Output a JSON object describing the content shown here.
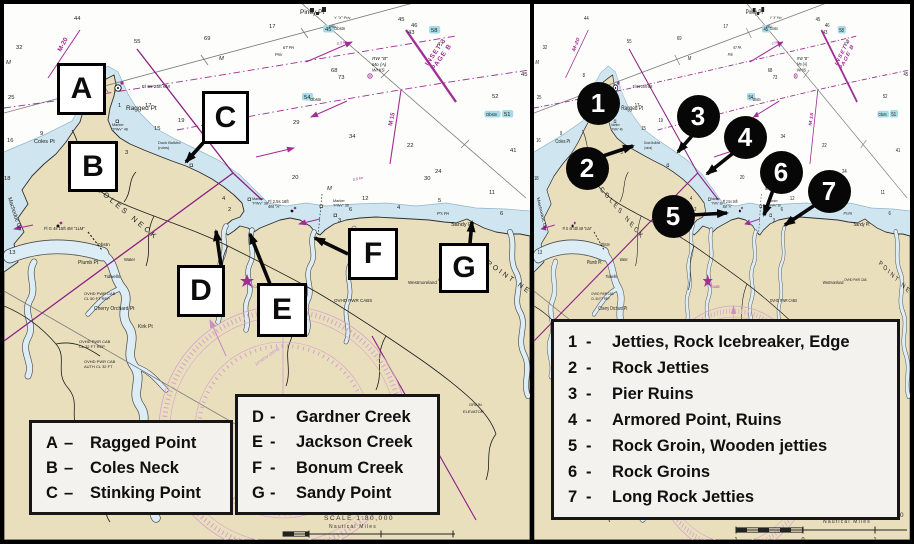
{
  "colors": {
    "land": "#e9dfbd",
    "shallow_water": "#cfe5ef",
    "creek": "#dcedf5",
    "magenta": "#a12d96",
    "pale_rose": "#d5a3cc",
    "teal_highlight": "#a8dbe8",
    "marker_black": "#070707"
  },
  "map": {
    "labels": [
      {
        "t": "Piney Pt",
        "x": 296,
        "y": 10,
        "s": 6.5
      },
      {
        "t": "Ragged Pt",
        "x": 122,
        "y": 106,
        "s": 6.5
      },
      {
        "t": "Coles Pt",
        "x": 30,
        "y": 139,
        "s": 5.5
      },
      {
        "t": "COLES NECK",
        "x": 92,
        "y": 186,
        "s": 7.5,
        "r": 40,
        "ls": 3
      },
      {
        "t": "Machodoc Cr",
        "x": 4,
        "y": 194,
        "s": 5.5,
        "r": 72
      },
      {
        "t": "Plumb Pt",
        "x": 74,
        "y": 260,
        "s": 5
      },
      {
        "t": "Tidwells",
        "x": 100,
        "y": 274,
        "s": 4.5
      },
      {
        "t": "Cherry Orchard Pt",
        "x": 90,
        "y": 306,
        "s": 5
      },
      {
        "t": "Kirk Pt",
        "x": 134,
        "y": 324,
        "s": 5
      },
      {
        "t": "Sandy Pt",
        "x": 447,
        "y": 222,
        "s": 5.5
      },
      {
        "t": "POINT NECK",
        "x": 482,
        "y": 260,
        "s": 7,
        "r": 35,
        "ls": 2.5
      },
      {
        "t": "Westmoreland",
        "x": 404,
        "y": 280,
        "s": 4.5
      },
      {
        "t": "Obstn",
        "x": 93,
        "y": 242,
        "s": 4.8
      },
      {
        "t": "Water",
        "x": 120,
        "y": 257,
        "s": 4.2
      },
      {
        "t": "Fl 6s 25ft 6M",
        "x": 138,
        "y": 84,
        "s": 4.8
      },
      {
        "t": "Fl G 4s 15ft 4M \"1LM\"",
        "x": 40,
        "y": 226,
        "s": 4.2
      },
      {
        "lines": [
          "Fl 2.5s 16ft",
          "4M \"A\""
        ],
        "x": 264,
        "y": 199,
        "s": 4.2
      },
      {
        "lines": [
          "RW \"B\"",
          "Mo (A)",
          "WHIS"
        ],
        "x": 368,
        "y": 56,
        "s": 4.8,
        "i": 1
      },
      {
        "t": "Priv",
        "x": 271,
        "y": 52,
        "s": 4.2,
        "i": 1
      },
      {
        "t": "Priv",
        "x": 325,
        "y": 24,
        "s": 4.2,
        "i": 1
      },
      {
        "t": "67 PA",
        "x": 279,
        "y": 45,
        "s": 4.2,
        "i": 1
      },
      {
        "t": "Y \"X\" Priv",
        "x": 330,
        "y": 15,
        "s": 3.8,
        "i": 1
      },
      {
        "lines": [
          "Dock Bulkhd",
          "(ruins)"
        ],
        "x": 154,
        "y": 140,
        "s": 4
      },
      {
        "lines": [
          "Marker",
          "\"PWv\" 46"
        ],
        "x": 108,
        "y": 122,
        "s": 3.8
      },
      {
        "lines": [
          "Marker",
          "\"PWv\" 38"
        ],
        "x": 248,
        "y": 196,
        "s": 3.8
      },
      {
        "lines": [
          "Marker",
          "\"PWv\" 38"
        ],
        "x": 329,
        "y": 198,
        "s": 3.8
      },
      {
        "t": "OVHD PWR CABS",
        "x": 330,
        "y": 298,
        "s": 4.5
      },
      {
        "lines": [
          "OVHD PWR CAB",
          "CL 50 FT REP"
        ],
        "x": 80,
        "y": 291,
        "s": 4
      },
      {
        "lines": [
          "OVHD PWR CAB",
          "CL 32 FT REP"
        ],
        "x": 75,
        "y": 339,
        "s": 4
      },
      {
        "lines": [
          "OVHD PWR CAB",
          "AUTH CL 32 FT"
        ],
        "x": 80,
        "y": 359,
        "s": 4
      },
      {
        "t": "OVHD PWR CAB",
        "x": 434,
        "y": 277,
        "s": 4
      },
      {
        "t": "M-20",
        "x": 57,
        "y": 48,
        "s": 6.5,
        "r": -62,
        "c": "#a12d96",
        "b": 1
      },
      {
        "t": "M 15",
        "x": 388,
        "y": 122,
        "s": 6,
        "r": -78,
        "c": "#a12d96",
        "b": 1
      },
      {
        "lines": [
          "INSET 3",
          "PAGE B"
        ],
        "x": 424,
        "y": 62,
        "s": 6.5,
        "r": -55,
        "c": "#a12d96",
        "b": 1,
        "ls": 1
      },
      {
        "t": "0.3 kn",
        "x": 333,
        "y": 41,
        "s": 3.8,
        "r": -12,
        "c": "#a12d96",
        "i": 1
      },
      {
        "t": "0.5 kn",
        "x": 349,
        "y": 177,
        "s": 3.8,
        "r": -12,
        "c": "#a12d96",
        "i": 1
      },
      {
        "t": "10°48'W (2016)",
        "x": 252,
        "y": 362,
        "s": 4.2,
        "r": -35,
        "c": "#c98fc2",
        "i": 1
      },
      {
        "t": "T CABS",
        "x": 246,
        "y": 284,
        "s": 3.8,
        "c": "#a12d96"
      },
      {
        "t": "Obstn",
        "x": 306,
        "y": 97,
        "s": 4.2
      },
      {
        "t": "Obstn",
        "x": 330,
        "y": 26,
        "s": 4.2
      },
      {
        "t": "Obstn",
        "x": 482,
        "y": 112,
        "s": 4.2,
        "hl": 1
      },
      {
        "t": "GRAIN",
        "x": 465,
        "y": 402,
        "s": 4
      },
      {
        "t": "ELEVATOR",
        "x": 459,
        "y": 409,
        "s": 4
      },
      {
        "t": "P's PA",
        "x": 433,
        "y": 211,
        "s": 4.2,
        "i": 1
      }
    ],
    "depths": [
      {
        "v": "44",
        "x": 70,
        "y": 16
      },
      {
        "v": "55",
        "x": 130,
        "y": 39
      },
      {
        "v": "69",
        "x": 200,
        "y": 36
      },
      {
        "v": "17",
        "x": 265,
        "y": 24
      },
      {
        "v": "M",
        "x": 215,
        "y": 56,
        "i": 1
      },
      {
        "v": "32",
        "x": 12,
        "y": 45
      },
      {
        "v": "M",
        "x": 2,
        "y": 60,
        "i": 1
      },
      {
        "v": "25",
        "x": 4,
        "y": 95
      },
      {
        "v": "16",
        "x": 3,
        "y": 138
      },
      {
        "v": "18",
        "x": 0,
        "y": 176
      },
      {
        "v": "13",
        "x": 5,
        "y": 250
      },
      {
        "v": "9",
        "x": 36,
        "y": 131
      },
      {
        "v": "8",
        "x": 68,
        "y": 73
      },
      {
        "v": "3",
        "x": 121,
        "y": 150
      },
      {
        "v": "17",
        "x": 141,
        "y": 103
      },
      {
        "v": "15",
        "x": 150,
        "y": 126
      },
      {
        "v": "19",
        "x": 174,
        "y": 118
      },
      {
        "v": "1",
        "x": 114,
        "y": 103
      },
      {
        "v": "3",
        "x": 88,
        "y": 162
      },
      {
        "v": "4",
        "x": 218,
        "y": 196
      },
      {
        "v": "2",
        "x": 224,
        "y": 207
      },
      {
        "v": "20",
        "x": 288,
        "y": 175
      },
      {
        "v": "M",
        "x": 323,
        "y": 186,
        "i": 1
      },
      {
        "v": "12",
        "x": 358,
        "y": 196
      },
      {
        "v": "6",
        "x": 345,
        "y": 207
      },
      {
        "v": "3",
        "x": 334,
        "y": 218
      },
      {
        "v": "4",
        "x": 393,
        "y": 205
      },
      {
        "v": "30",
        "x": 420,
        "y": 176
      },
      {
        "v": "29",
        "x": 289,
        "y": 120
      },
      {
        "v": "34",
        "x": 345,
        "y": 134
      },
      {
        "v": "22",
        "x": 403,
        "y": 143
      },
      {
        "v": "24",
        "x": 431,
        "y": 169
      },
      {
        "v": "11",
        "x": 485,
        "y": 190
      },
      {
        "v": "5",
        "x": 434,
        "y": 198
      },
      {
        "v": "6",
        "x": 496,
        "y": 211
      },
      {
        "v": "52",
        "x": 488,
        "y": 94
      },
      {
        "v": "45",
        "x": 517,
        "y": 72
      },
      {
        "v": "41",
        "x": 506,
        "y": 148
      },
      {
        "v": "47",
        "x": 433,
        "y": 42
      },
      {
        "v": "45",
        "x": 394,
        "y": 17
      },
      {
        "v": "46",
        "x": 407,
        "y": 23
      },
      {
        "v": "43",
        "x": 404,
        "y": 30
      },
      {
        "v": "68",
        "x": 327,
        "y": 68
      },
      {
        "v": "73",
        "x": 334,
        "y": 75
      },
      {
        "v": "58",
        "x": 427,
        "y": 28,
        "hl": 1
      },
      {
        "v": "54",
        "x": 300,
        "y": 95,
        "hl": 1
      },
      {
        "v": "45",
        "x": 321,
        "y": 27,
        "hl": 1
      },
      {
        "v": "51",
        "x": 500,
        "y": 112,
        "hl": 1
      }
    ]
  },
  "panels": {
    "left": {
      "boxes": [
        {
          "label": "A",
          "x": 53,
          "y": 59,
          "w": 49,
          "h": 52
        },
        {
          "label": "B",
          "x": 64,
          "y": 137,
          "w": 50,
          "h": 51
        },
        {
          "label": "C",
          "x": 198,
          "y": 87,
          "w": 47,
          "h": 53
        },
        {
          "label": "D",
          "x": 173,
          "y": 261,
          "w": 48,
          "h": 52
        },
        {
          "label": "E",
          "x": 253,
          "y": 279,
          "w": 50,
          "h": 54
        },
        {
          "label": "F",
          "x": 344,
          "y": 224,
          "w": 50,
          "h": 52
        },
        {
          "label": "G",
          "x": 435,
          "y": 239,
          "w": 50,
          "h": 50
        }
      ],
      "arrows": [
        [
          199,
          139,
          182,
          158
        ],
        [
          217,
          261,
          212,
          227
        ],
        [
          266,
          280,
          246,
          230
        ],
        [
          344,
          250,
          311,
          234
        ],
        [
          466,
          239,
          468,
          218
        ]
      ],
      "legends": [
        {
          "x": 25,
          "y": 416,
          "w": 204,
          "h": 95,
          "sep": "–",
          "items": [
            [
              "A",
              "Ragged Point"
            ],
            [
              "B",
              "Coles Neck"
            ],
            [
              "C",
              "Stinking Point"
            ]
          ]
        },
        {
          "x": 231,
          "y": 390,
          "w": 205,
          "h": 121,
          "sep": "-",
          "items": [
            [
              "D",
              "Gardner Creek"
            ],
            [
              "E",
              "Jackson Creek"
            ],
            [
              "F",
              "Bonum Creek"
            ],
            [
              "G",
              "Sandy Point"
            ]
          ]
        }
      ],
      "scale": {
        "label": "SCALE 1:80,000",
        "label_x": 355,
        "label_y": 516,
        "units": "Nautical Miles",
        "units_x": 349,
        "units_y": 524,
        "bar": {
          "x1": 279,
          "x2": 451,
          "c2": 305,
          "y": 530
        },
        "ticks": [
          [
            "0",
            305
          ],
          [
            "1",
            377
          ],
          [
            "2",
            449
          ]
        ]
      }
    },
    "right": {
      "circles": [
        [
          "1",
          64,
          99
        ],
        [
          "2",
          53,
          164
        ],
        [
          "3",
          164,
          112
        ],
        [
          "4",
          211,
          133
        ],
        [
          "5",
          139,
          212
        ],
        [
          "6",
          247,
          168
        ],
        [
          "7",
          295,
          187
        ]
      ],
      "arrows": [
        [
          66,
          153,
          99,
          142
        ],
        [
          163,
          126,
          144,
          148
        ],
        [
          203,
          146,
          173,
          170
        ],
        [
          158,
          211,
          193,
          209
        ],
        [
          239,
          186,
          230,
          211
        ],
        [
          284,
          199,
          251,
          221
        ]
      ],
      "legends": [
        {
          "x": 17,
          "y": 315,
          "w": 349,
          "h": 201,
          "sep": "-",
          "items": [
            [
              "1",
              "Jetties, Rock Icebreaker, Edge"
            ],
            [
              "2",
              "Rock Jetties"
            ],
            [
              "3",
              "Pier Ruins"
            ],
            [
              "4",
              "Armored Point, Ruins"
            ],
            [
              "5",
              "Rock Groin, Wooden jetties"
            ],
            [
              "6",
              "Rock Groins"
            ],
            [
              "7",
              "Long Rock Jetties"
            ]
          ]
        }
      ],
      "scale": {
        "label": "SCALE 1:80,000",
        "label_x": 336,
        "label_y": 513,
        "units": "Nautical Miles",
        "units_x": 313,
        "units_y": 519,
        "bar": {
          "x1": 202,
          "x2": 373,
          "c2": 269,
          "y": 526
        },
        "ticks": [
          [
            "1",
            202
          ],
          [
            "0",
            269
          ],
          [
            "1",
            341
          ]
        ]
      }
    }
  }
}
